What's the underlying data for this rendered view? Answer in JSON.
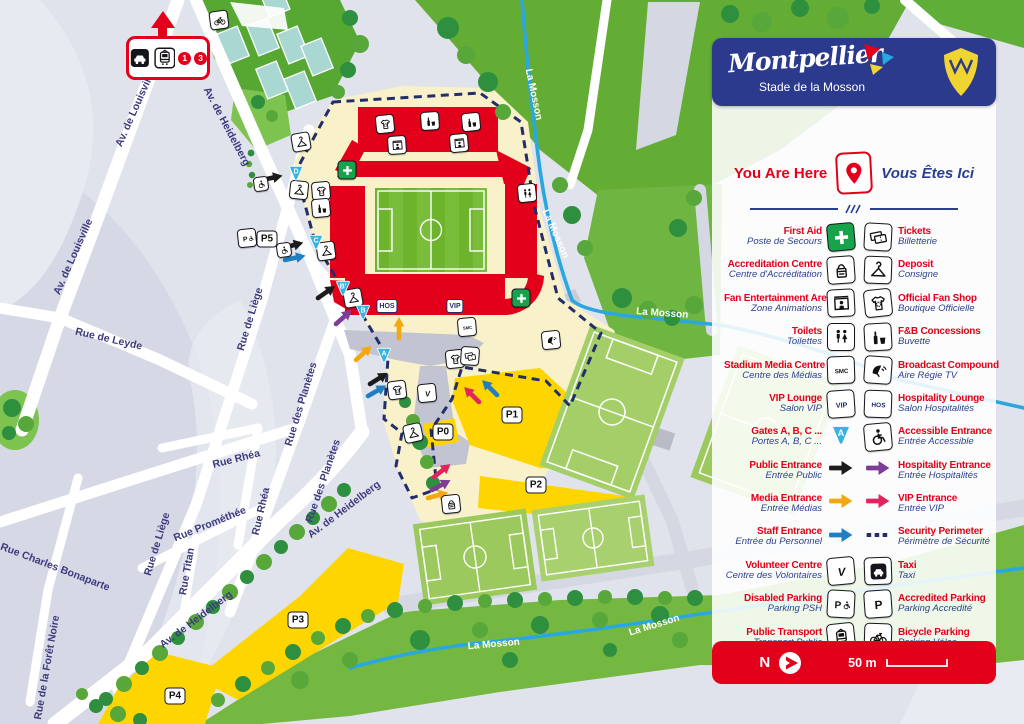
{
  "header": {
    "wordmark": "Montpellier",
    "subtitle": "Stade de la Mosson"
  },
  "you_are_here": {
    "en": "You Are Here",
    "fr": "Vous Êtes Ici"
  },
  "icon_text": {
    "smc": "SMC",
    "vip": "VIP",
    "hos": "HOS",
    "volunteer": "V",
    "parking": "P",
    "gate_letter": "A"
  },
  "legend_rows": [
    {
      "left": {
        "en": "First Aid",
        "fr": "Poste de Secours",
        "icon": "first-aid"
      },
      "right": {
        "en": "Tickets",
        "fr": "Billetterie",
        "icon": "tickets"
      }
    },
    {
      "left": {
        "en": "Accreditation Centre",
        "fr": "Centre d'Accréditation",
        "icon": "accreditation"
      },
      "right": {
        "en": "Deposit",
        "fr": "Consigne",
        "icon": "deposit"
      }
    },
    {
      "left": {
        "en": "Fan Entertainment Area",
        "fr": "Zone Animations",
        "icon": "fan-entertainment"
      },
      "right": {
        "en": "Official Fan Shop",
        "fr": "Boutique Officielle",
        "icon": "fan-shop"
      }
    },
    {
      "left": {
        "en": "Toilets",
        "fr": "Toilettes",
        "icon": "toilets"
      },
      "right": {
        "en": "F&B Concessions",
        "fr": "Buvette",
        "icon": "fnb"
      }
    },
    {
      "left": {
        "en": "Stadium Media Centre",
        "fr": "Centre des Médias",
        "icon": "smc"
      },
      "right": {
        "en": "Broadcast Compound",
        "fr": "Aire Régie TV",
        "icon": "broadcast"
      }
    },
    {
      "left": {
        "en": "VIP Lounge",
        "fr": "Salon VIP",
        "icon": "vip"
      },
      "right": {
        "en": "Hospitality Lounge",
        "fr": "Salon Hospitalités",
        "icon": "hos"
      }
    },
    {
      "left": {
        "en": "Gates A, B, C ...",
        "fr": "Portes A, B, C ...",
        "icon": "gate"
      },
      "right": {
        "en": "Accessible Entrance",
        "fr": "Entrée Accessible",
        "icon": "accessible"
      }
    },
    {
      "left": {
        "en": "Public Entrance",
        "fr": "Entrée Public",
        "icon": "arrow-black"
      },
      "right": {
        "en": "Hospitality Entrance",
        "fr": "Entrée Hospitalités",
        "icon": "arrow-purple"
      }
    },
    {
      "left": {
        "en": "Media Entrance",
        "fr": "Entrée Médias",
        "icon": "arrow-yellow"
      },
      "right": {
        "en": "VIP Entrance",
        "fr": "Entrée VIP",
        "icon": "arrow-pink"
      }
    },
    {
      "left": {
        "en": "Staff Entrance",
        "fr": "Entrée du Personnel",
        "icon": "arrow-blue"
      },
      "right": {
        "en": "Security Perimeter",
        "fr": "Périmètre de Sécurité",
        "icon": "dashed"
      }
    },
    {
      "left": {
        "en": "Volunteer Centre",
        "fr": "Centre des Volontaires",
        "icon": "volunteer"
      },
      "right": {
        "en": "Taxi",
        "fr": "Taxi",
        "icon": "taxi"
      }
    },
    {
      "left": {
        "en": "Disabled Parking",
        "fr": "Parking PSH",
        "icon": "parking-disabled"
      },
      "right": {
        "en": "Accredited Parking",
        "fr": "Parking Accredité",
        "icon": "parking"
      }
    },
    {
      "left": {
        "en": "Public Transport",
        "fr": "Transport Public",
        "icon": "transport"
      },
      "right": {
        "en": "Bicycle Parking",
        "fr": "Parking Vélos",
        "icon": "bicycle"
      }
    }
  ],
  "footer": {
    "north": "N",
    "scale": "50 m"
  },
  "map": {
    "transport_lines": [
      "1",
      "3"
    ],
    "street_labels": [
      {
        "text": "Av. de Louisville",
        "x": 138,
        "y": 110,
        "rot": -66
      },
      {
        "text": "Av. de Louisville",
        "x": 76,
        "y": 258,
        "rot": -66
      },
      {
        "text": "Rue de Leyde",
        "x": 108,
        "y": 342,
        "rot": 13
      },
      {
        "text": "Rue de Liège",
        "x": 253,
        "y": 320,
        "rot": -73
      },
      {
        "text": "Rue de Liège",
        "x": 160,
        "y": 545,
        "rot": -73
      },
      {
        "text": "Rue des Planètes",
        "x": 304,
        "y": 405,
        "rot": -73
      },
      {
        "text": "Rue des Planètes",
        "x": 326,
        "y": 482,
        "rot": -71
      },
      {
        "text": "Rue Rhéa",
        "x": 237,
        "y": 462,
        "rot": -14
      },
      {
        "text": "Rue Rhéa",
        "x": 264,
        "y": 512,
        "rot": -77
      },
      {
        "text": "Rue Prométhée",
        "x": 211,
        "y": 527,
        "rot": -22
      },
      {
        "text": "Rue Titan",
        "x": 190,
        "y": 572,
        "rot": -80
      },
      {
        "text": "Rue Charles Bonaparte",
        "x": 54,
        "y": 570,
        "rot": 21
      },
      {
        "text": "Rue de la Forêt Noire",
        "x": 50,
        "y": 668,
        "rot": -80
      },
      {
        "text": "Av. de Heidelberg",
        "x": 224,
        "y": 128,
        "rot": 62
      },
      {
        "text": "Av. de Heidelberg",
        "x": 346,
        "y": 512,
        "rot": -37
      },
      {
        "text": "Av. de Heidelberg",
        "x": 198,
        "y": 622,
        "rot": -37
      }
    ],
    "river_labels": [
      {
        "text": "La Mosson",
        "x": 531,
        "y": 95,
        "rot": 78
      },
      {
        "text": "La Mosson",
        "x": 553,
        "y": 235,
        "rot": 66
      },
      {
        "text": "La Mosson",
        "x": 662,
        "y": 316,
        "rot": 4
      },
      {
        "text": "La Mosson",
        "x": 494,
        "y": 647,
        "rot": -5
      },
      {
        "text": "La Mosson",
        "x": 655,
        "y": 628,
        "rot": -17
      }
    ],
    "gates": [
      {
        "label": "D",
        "x": 296,
        "y": 173
      },
      {
        "label": "C",
        "x": 316,
        "y": 242
      },
      {
        "label": "B'",
        "x": 343,
        "y": 288
      },
      {
        "label": "B",
        "x": 363,
        "y": 312
      },
      {
        "label": "A",
        "x": 384,
        "y": 355
      }
    ],
    "parkings": [
      {
        "label": "P5",
        "x": 267,
        "y": 239
      },
      {
        "label": "P0",
        "x": 443,
        "y": 432
      },
      {
        "label": "P1",
        "x": 512,
        "y": 415
      },
      {
        "label": "P2",
        "x": 536,
        "y": 485
      },
      {
        "label": "P3",
        "x": 298,
        "y": 620
      },
      {
        "label": "P4",
        "x": 175,
        "y": 696
      }
    ],
    "stand_labels": [
      {
        "text": "HOS",
        "x": 387,
        "y": 306
      },
      {
        "text": "VIP",
        "x": 455,
        "y": 306
      }
    ],
    "icons": [
      {
        "icon": "bicycle",
        "x": 219,
        "y": 20,
        "rot": -8
      },
      {
        "icon": "deposit",
        "x": 301,
        "y": 142,
        "rot": -10
      },
      {
        "icon": "accessible",
        "x": 261,
        "y": 184,
        "rot": -8,
        "small": true
      },
      {
        "icon": "deposit",
        "x": 299,
        "y": 190,
        "rot": 6
      },
      {
        "icon": "fan-shop",
        "x": 321,
        "y": 191,
        "rot": -5
      },
      {
        "icon": "fnb",
        "x": 321,
        "y": 208,
        "rot": -5
      },
      {
        "icon": "deposit",
        "x": 326,
        "y": 251,
        "rot": -8
      },
      {
        "icon": "accessible",
        "x": 284,
        "y": 250,
        "rot": -8,
        "small": true
      },
      {
        "icon": "deposit",
        "x": 353,
        "y": 298,
        "rot": -10
      },
      {
        "icon": "fan-shop",
        "x": 385,
        "y": 124,
        "rot": -6
      },
      {
        "icon": "fnb",
        "x": 430,
        "y": 121,
        "rot": -4
      },
      {
        "icon": "fnb",
        "x": 471,
        "y": 122,
        "rot": -6
      },
      {
        "icon": "fan-entertainment",
        "x": 397,
        "y": 145,
        "rot": -4
      },
      {
        "icon": "fan-entertainment",
        "x": 459,
        "y": 143,
        "rot": -5
      },
      {
        "icon": "first-aid",
        "x": 347,
        "y": 170,
        "rot": 0,
        "green": true
      },
      {
        "icon": "first-aid",
        "x": 521,
        "y": 298,
        "rot": 0,
        "green": true
      },
      {
        "icon": "toilets",
        "x": 527,
        "y": 193,
        "rot": -6
      },
      {
        "icon": "smc",
        "x": 467,
        "y": 327,
        "rot": -5
      },
      {
        "icon": "fan-shop",
        "x": 455,
        "y": 359,
        "rot": -6
      },
      {
        "icon": "tickets",
        "x": 470,
        "y": 356,
        "rot": 4
      },
      {
        "icon": "deposit",
        "x": 413,
        "y": 433,
        "rot": -12
      },
      {
        "icon": "fan-shop",
        "x": 397,
        "y": 390,
        "rot": -7
      },
      {
        "icon": "volunteer",
        "x": 427,
        "y": 393,
        "rot": -6
      },
      {
        "icon": "broadcast",
        "x": 551,
        "y": 340,
        "rot": -6
      },
      {
        "icon": "accreditation",
        "x": 451,
        "y": 504,
        "rot": -6
      },
      {
        "icon": "parking-disabled",
        "x": 247,
        "y": 238,
        "rot": -6
      }
    ],
    "arrows": [
      {
        "color": "black",
        "x": 262,
        "y": 180,
        "rot": -12
      },
      {
        "color": "black",
        "x": 283,
        "y": 248,
        "rot": -15
      },
      {
        "color": "black",
        "x": 318,
        "y": 298,
        "rot": -35
      },
      {
        "color": "black",
        "x": 370,
        "y": 384,
        "rot": -32
      },
      {
        "color": "blue",
        "x": 285,
        "y": 260,
        "rot": -12
      },
      {
        "color": "blue",
        "x": 368,
        "y": 396,
        "rot": -30
      },
      {
        "color": "blue",
        "x": 497,
        "y": 395,
        "rot": -135
      },
      {
        "color": "purple",
        "x": 336,
        "y": 324,
        "rot": -42
      },
      {
        "color": "purple",
        "x": 432,
        "y": 490,
        "rot": -28
      },
      {
        "color": "yellow",
        "x": 356,
        "y": 360,
        "rot": -42
      },
      {
        "color": "yellow",
        "x": 399,
        "y": 338,
        "rot": -90
      },
      {
        "color": "yellow",
        "x": 428,
        "y": 498,
        "rot": -15
      },
      {
        "color": "pink",
        "x": 479,
        "y": 402,
        "rot": -135
      },
      {
        "color": "pink",
        "x": 434,
        "y": 477,
        "rot": -38
      }
    ]
  }
}
